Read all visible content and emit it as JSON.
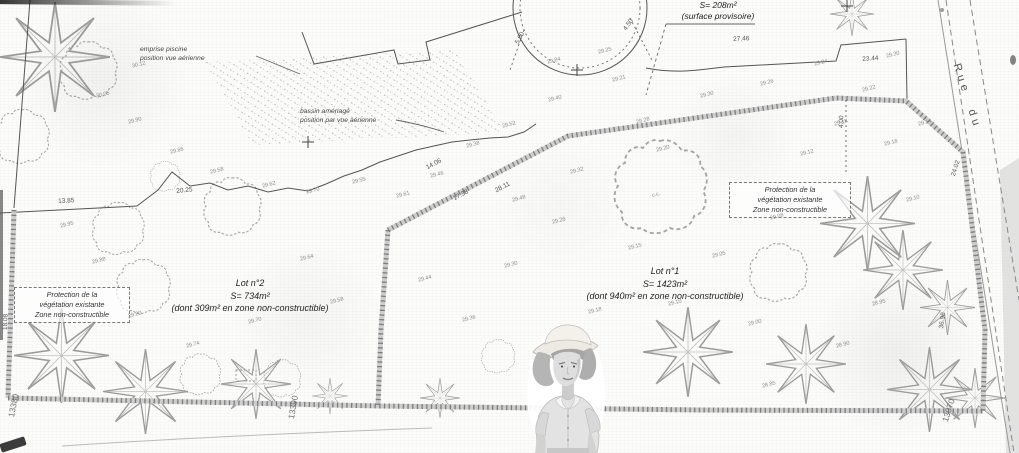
{
  "plan": {
    "notes": {
      "provisional": {
        "l1": "S= 208m²",
        "l2": "(surface provisoire)"
      },
      "pool": {
        "l1": "emprise piscine",
        "l2": "position vue aérienne"
      },
      "basin": {
        "l1": "bassin aménagé",
        "l2": "position par vue aérienne"
      }
    },
    "lots": {
      "lot2": {
        "l1": "Lot n°2",
        "l2": "S= 734m²",
        "l3": "(dont 309m² en zone non-constructible)"
      },
      "lot1": {
        "l1": "Lot n°1",
        "l2": "S= 1423m²",
        "l3": "(dont 940m² en zone non-constructible)"
      }
    },
    "protection_left": {
      "l1": "Protection de la",
      "l2": "végétation existante",
      "l3": "Zone non-constructible"
    },
    "protection_right": {
      "l1": "Protection de la",
      "l2": "végétation existante",
      "l3": "Zone non-constructible"
    },
    "street_name": "Rue du",
    "grid_labels": [
      {
        "t": "13380",
        "x": 6,
        "y": 416,
        "r": -78
      },
      {
        "t": "13390",
        "x": 286,
        "y": 418,
        "r": -80
      },
      {
        "t": "13070",
        "x": 940,
        "y": 420,
        "r": -72
      }
    ],
    "dimensions": [
      {
        "t": "27.46",
        "x": 733,
        "y": 36,
        "r": -3
      },
      {
        "t": "23.44",
        "x": 862,
        "y": 56,
        "r": -4
      },
      {
        "t": "4.00",
        "x": 838,
        "y": 128,
        "r": -88
      },
      {
        "t": "4.50",
        "x": 622,
        "y": 28,
        "r": -55
      },
      {
        "t": "5.00",
        "x": 514,
        "y": 42,
        "r": -62
      },
      {
        "t": "14.06",
        "x": 425,
        "y": 165,
        "r": -28
      },
      {
        "t": "17.38",
        "x": 452,
        "y": 196,
        "r": -28
      },
      {
        "t": "28.11",
        "x": 494,
        "y": 188,
        "r": -28
      },
      {
        "t": "13.85",
        "x": 58,
        "y": 198,
        "r": -3
      },
      {
        "t": "18.08",
        "x": 2,
        "y": 330,
        "r": -88
      },
      {
        "t": "20.25",
        "x": 176,
        "y": 188,
        "r": -6
      },
      {
        "t": "36.98",
        "x": 938,
        "y": 328,
        "r": -82
      },
      {
        "t": "24.02",
        "x": 950,
        "y": 175,
        "r": -72
      }
    ],
    "spot_elevations": [
      {
        "t": "29.84",
        "x": 547,
        "y": 58
      },
      {
        "t": "29.25",
        "x": 598,
        "y": 48
      },
      {
        "t": "29.21",
        "x": 612,
        "y": 76
      },
      {
        "t": "29.40",
        "x": 548,
        "y": 96
      },
      {
        "t": "29.52",
        "x": 502,
        "y": 122
      },
      {
        "t": "29.38",
        "x": 466,
        "y": 142
      },
      {
        "t": "29.46",
        "x": 430,
        "y": 172
      },
      {
        "t": "29.61",
        "x": 396,
        "y": 192
      },
      {
        "t": "29.55",
        "x": 352,
        "y": 178
      },
      {
        "t": "29.70",
        "x": 306,
        "y": 188
      },
      {
        "t": "29.62",
        "x": 262,
        "y": 182
      },
      {
        "t": "29.58",
        "x": 210,
        "y": 168
      },
      {
        "t": "29.66",
        "x": 170,
        "y": 148
      },
      {
        "t": "29.90",
        "x": 128,
        "y": 118
      },
      {
        "t": "30.05",
        "x": 96,
        "y": 92
      },
      {
        "t": "30.12",
        "x": 132,
        "y": 62
      },
      {
        "t": "29.95",
        "x": 60,
        "y": 222
      },
      {
        "t": "29.88",
        "x": 92,
        "y": 258
      },
      {
        "t": "29.80",
        "x": 128,
        "y": 312
      },
      {
        "t": "29.74",
        "x": 186,
        "y": 342
      },
      {
        "t": "29.70",
        "x": 248,
        "y": 318
      },
      {
        "t": "29.58",
        "x": 330,
        "y": 298
      },
      {
        "t": "29.64",
        "x": 300,
        "y": 255
      },
      {
        "t": "29.44",
        "x": 418,
        "y": 276
      },
      {
        "t": "29.36",
        "x": 462,
        "y": 316
      },
      {
        "t": "29.30",
        "x": 504,
        "y": 262
      },
      {
        "t": "29.26",
        "x": 552,
        "y": 218
      },
      {
        "t": "29.18",
        "x": 588,
        "y": 308
      },
      {
        "t": "29.15",
        "x": 628,
        "y": 244
      },
      {
        "t": "29.10",
        "x": 668,
        "y": 300
      },
      {
        "t": "29.05",
        "x": 712,
        "y": 252
      },
      {
        "t": "29.00",
        "x": 748,
        "y": 320
      },
      {
        "t": "29.08",
        "x": 770,
        "y": 214
      },
      {
        "t": "29.12",
        "x": 800,
        "y": 150
      },
      {
        "t": "29.18",
        "x": 834,
        "y": 120
      },
      {
        "t": "29.22",
        "x": 862,
        "y": 86
      },
      {
        "t": "29.16",
        "x": 884,
        "y": 140
      },
      {
        "t": "29.10",
        "x": 906,
        "y": 196
      },
      {
        "t": "28.95",
        "x": 872,
        "y": 300
      },
      {
        "t": "28.90",
        "x": 836,
        "y": 342
      },
      {
        "t": "28.85",
        "x": 762,
        "y": 382
      },
      {
        "t": "29.20",
        "x": 656,
        "y": 146
      },
      {
        "t": "c.c.",
        "x": 652,
        "y": 192
      },
      {
        "t": "29.48",
        "x": 512,
        "y": 196
      },
      {
        "t": "29.32",
        "x": 570,
        "y": 168
      },
      {
        "t": "29.28",
        "x": 636,
        "y": 118
      },
      {
        "t": "29.30",
        "x": 700,
        "y": 92
      },
      {
        "t": "29.26",
        "x": 760,
        "y": 80
      },
      {
        "t": "29.24",
        "x": 814,
        "y": 60
      },
      {
        "t": "29.30",
        "x": 886,
        "y": 52
      },
      {
        "t": "29.14",
        "x": 918,
        "y": 120
      }
    ]
  }
}
